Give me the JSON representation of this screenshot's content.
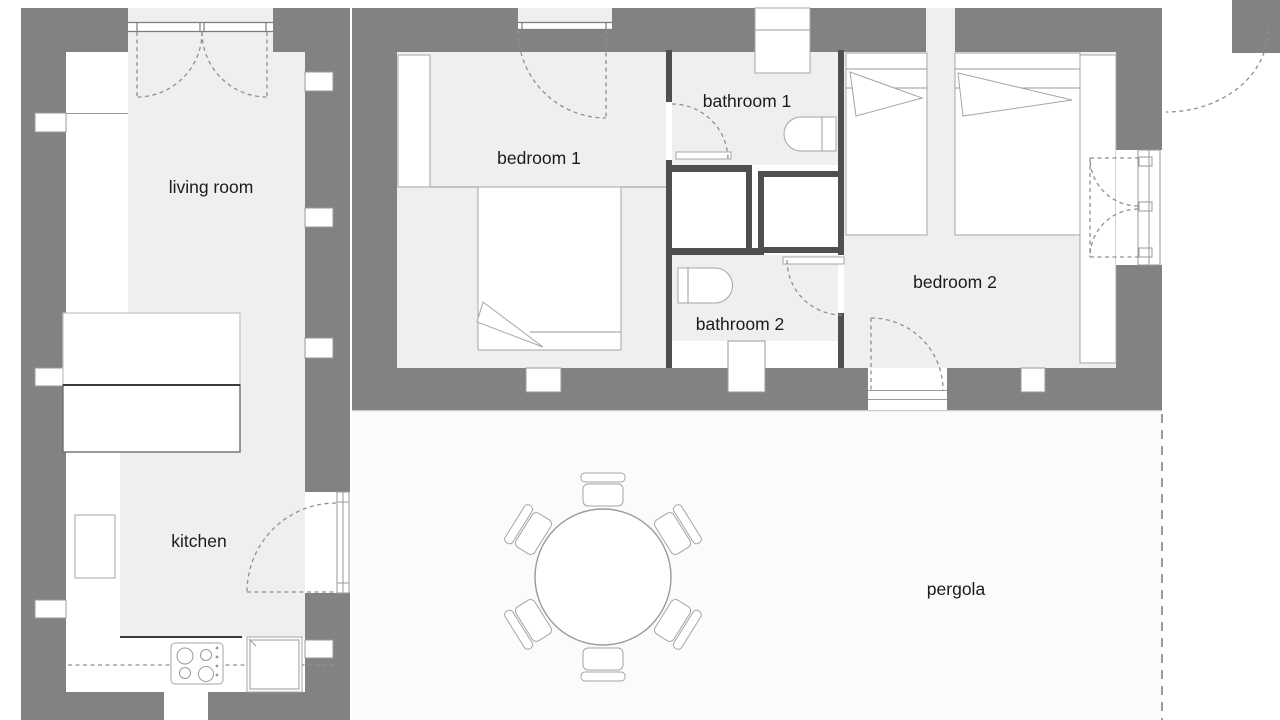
{
  "title": "two-bedroom house floor plan with pergola",
  "rooms": {
    "living_room": "living room",
    "kitchen": "kitchen",
    "bedroom1": "bedroom 1",
    "bathroom1": "bathroom 1",
    "bathroom2": "bathroom 2",
    "bedroom2": "bedroom 2",
    "pergola": "pergola"
  },
  "colors": {
    "wall_gray": "#828282",
    "partition_dark": "#4f4f4f",
    "floor_light": "#efefef",
    "pergola_slab": "#fbfbfb",
    "furniture_outline": "#9a9a9a",
    "label_text": "#1b1b1b"
  }
}
